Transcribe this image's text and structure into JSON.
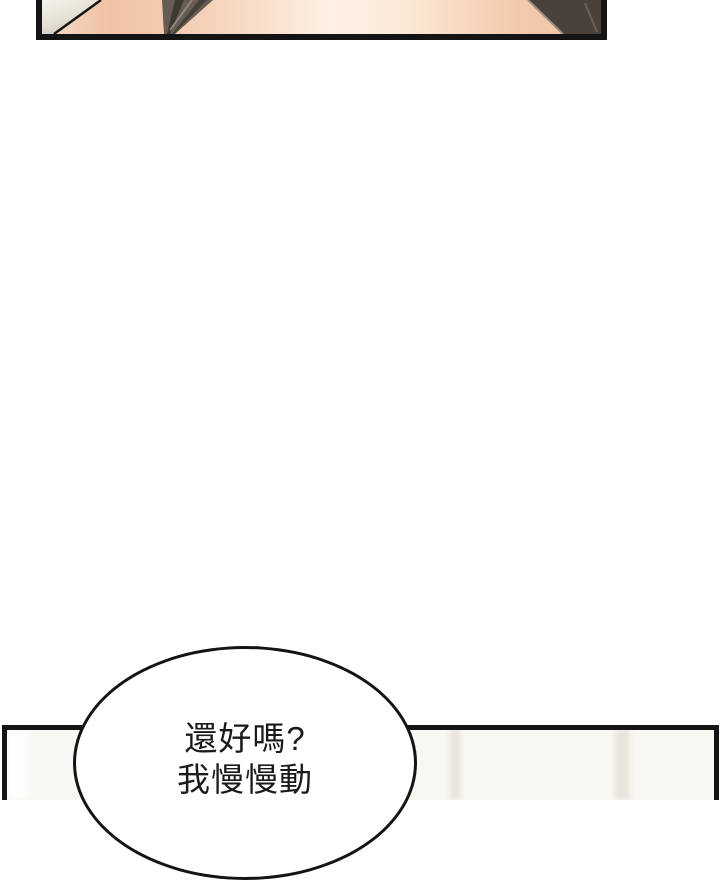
{
  "page": {
    "background": "#ffffff"
  },
  "top_panel": {
    "border_color": "#141414",
    "skin_highlight": "#fdf1e4",
    "skin_mid": "#f5d2ba",
    "skin_deep": "#f0c2a5",
    "ivory_light": "#f4f2ec",
    "ivory_dark": "#c9c3b5",
    "edge_line_color": "#161616",
    "hair_mid": "#675d54",
    "hair_dark": "#3f3933",
    "hair_dark2": "#46403a",
    "hair_mass": "#49413a",
    "hair_light_edge": "#9a8f82",
    "hair_streak": "#6b6158"
  },
  "bottom_panel": {
    "border_color": "#141414",
    "wall_color": "#f9f7f2",
    "stripe_color": "#e7e3da",
    "stripe_light_color": "#fefdfb"
  },
  "speech_bubble": {
    "line1": "還好嗎?",
    "line2": "我慢慢動",
    "text_color": "#1a1a1a",
    "fill": "#ffffff",
    "border_color": "#141414"
  }
}
